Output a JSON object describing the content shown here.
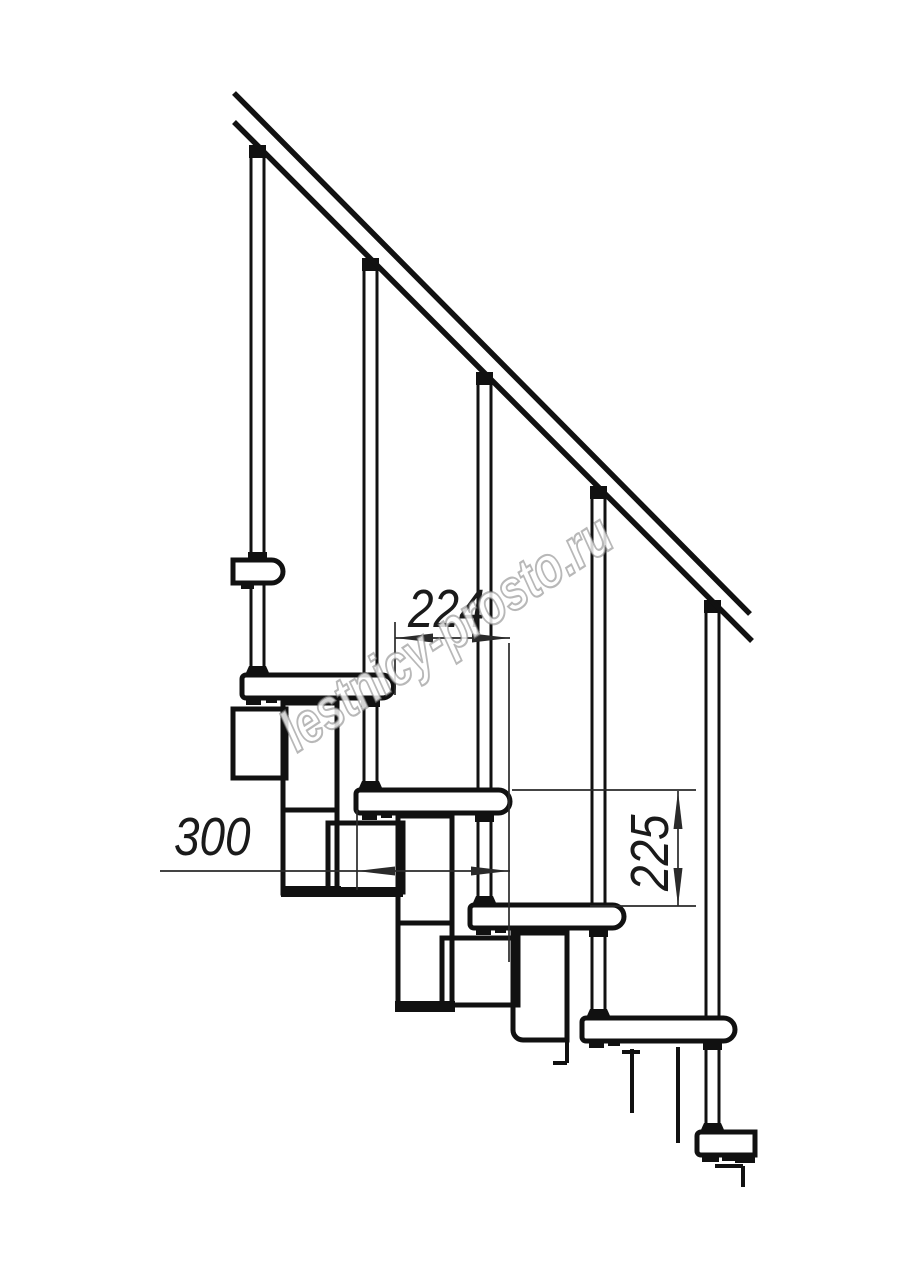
{
  "drawing": {
    "type": "staircase-side-elevation",
    "watermark": "lestnicy-prosto.ru",
    "dimensions": {
      "run": "224",
      "depth": "300",
      "rise": "225"
    },
    "colors": {
      "ink": "#111111",
      "dimension_ink": "#2a2a2a",
      "watermark_stroke": "#7d7d7d",
      "background": "#ffffff"
    }
  }
}
